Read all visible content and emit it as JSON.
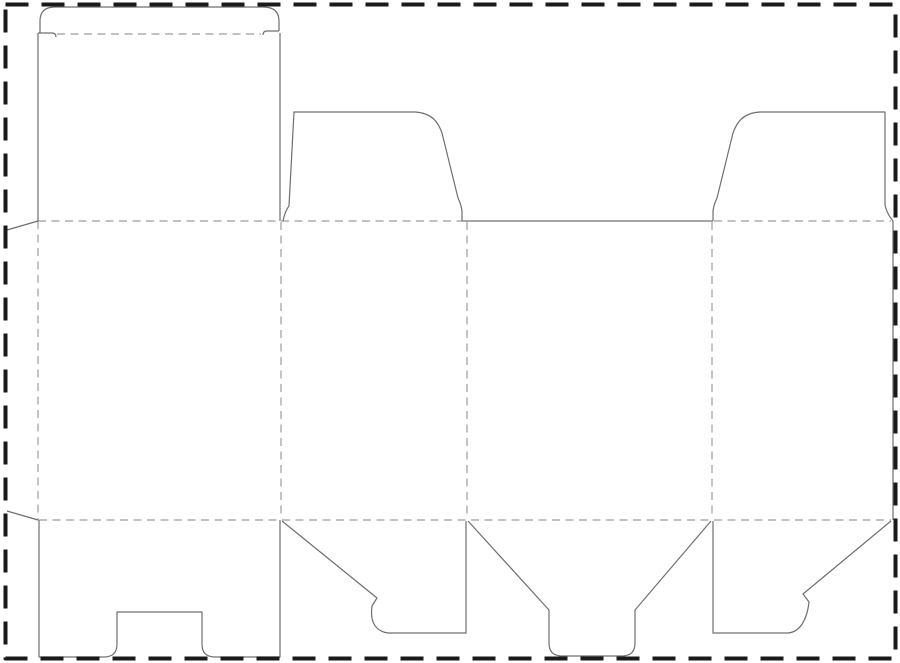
{
  "document": {
    "description": "Die-cut folding carton (box) dieline template with tuck top and snap-lock bottom",
    "background_color": "#ffffff"
  },
  "dieline": {
    "canvas": {
      "width": 900,
      "height": 663
    },
    "styles": {
      "cut_line": {
        "color": "#6f6f6f",
        "width": 1.2,
        "dash": ""
      },
      "fold_line": {
        "color": "#9c9c9c",
        "width": 1.2,
        "dash": "8 5.5"
      },
      "page_border": {
        "color": "#1a1a1a",
        "width": 4,
        "dash": "23 13"
      }
    },
    "page_border": {
      "x": 5.5,
      "y": 4.5,
      "width": 890,
      "height": 654
    },
    "cut_paths": [
      {
        "name": "tuck-flap-outline",
        "d": "M 40 33 L 40 21 Q 40 7 55 7 L 263 7 Q 279 7 279 21 L 279 31"
      },
      {
        "name": "tuck-shoulder-left",
        "d": "M 38 33 L 52 33 Q 56 33 56 37"
      },
      {
        "name": "tuck-shoulder-right",
        "d": "M 279 31 L 267 31 Q 263 31 263 35"
      },
      {
        "name": "lid-panel-left-edge",
        "d": "M 38 33 L 38 221"
      },
      {
        "name": "lid-panel-right-edge",
        "d": "M 280 33 L 280 221"
      },
      {
        "name": "glue-flap-top-edge",
        "d": "M 38 221 L 7 230"
      },
      {
        "name": "glue-flap-bottom-edge",
        "d": "M 38 520 L 7 511"
      },
      {
        "name": "top-dust-flap-left",
        "d": "M 283 221 Q 285 211 289 206 L 294 112 L 415 112 C 432 113 438 122 442 133 L 458 198 Q 461 204 462 211 L 462 221"
      },
      {
        "name": "top-center-edge",
        "d": "M 462 221 L 713 221"
      },
      {
        "name": "top-dust-flap-right",
        "d": "M 713 221 L 713 211 Q 714 204 717 198 L 733 133 C 737 122 743 113 760 112 L 885 112 L 885 205 Q 887 214 893 221"
      },
      {
        "name": "right-panel-edge",
        "d": "M 893 221 L 893 520"
      },
      {
        "name": "bottom-lock-panel",
        "d": "M 39 520 L 39 657 L 104 657 Q 117 657 117 644 L 117 612 L 202 612 L 202 644 Q 202 657 215 657 L 280 657 L 280 520"
      },
      {
        "name": "bottom-flap-left",
        "d": "M 282 521 L 377 598 L 372 606 C 370 620 374 631 388 633 L 466 633 L 466 521"
      },
      {
        "name": "bottom-tongue-flap",
        "d": "M 468 521 L 549 610 L 549 643 Q 549 656 562 656 L 622 656 Q 635 656 635 643 L 635 610 L 711 521"
      },
      {
        "name": "bottom-flap-right",
        "d": "M 713 521 L 713 633 L 788 633 C 800 632 807 620 809 602 L 803 594 L 891 521"
      }
    ],
    "fold_lines": [
      {
        "name": "tuck-fold",
        "d": "M 57 34 L 261 34"
      },
      {
        "name": "lid-fold",
        "d": "M 38 221 L 462 221"
      },
      {
        "name": "top-right-fold",
        "d": "M 714 221 L 891 221"
      },
      {
        "name": "bottom-fold",
        "d": "M 39 520 L 891 520"
      },
      {
        "name": "glue-flap-fold",
        "d": "M 38 221 L 38 520"
      },
      {
        "name": "panel-fold-1",
        "d": "M 281 222 L 281 519"
      },
      {
        "name": "panel-fold-2",
        "d": "M 467 222 L 467 519"
      },
      {
        "name": "panel-fold-3",
        "d": "M 712 222 L 712 519"
      }
    ]
  }
}
